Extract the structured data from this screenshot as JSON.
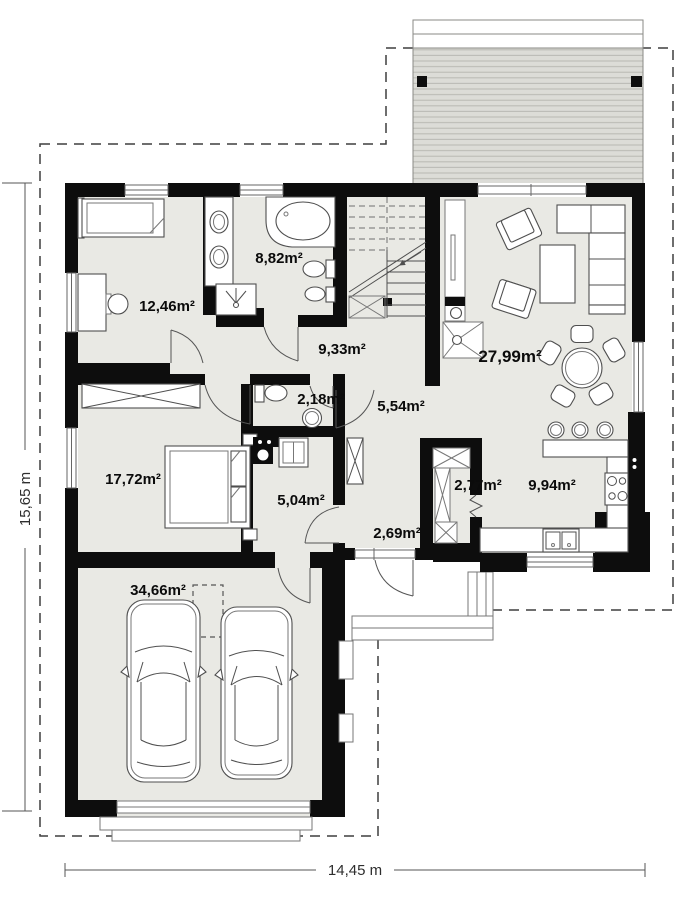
{
  "plan": {
    "rooms": [
      {
        "name": "bedroom-1",
        "area": "12,46m²"
      },
      {
        "name": "bathroom",
        "area": "8,82m²"
      },
      {
        "name": "hall",
        "area": "9,33m²"
      },
      {
        "name": "living-room",
        "area": "27,99m²"
      },
      {
        "name": "wc",
        "area": "2,18m²"
      },
      {
        "name": "corridor",
        "area": "5,54m²"
      },
      {
        "name": "bedroom-2",
        "area": "17,72m²"
      },
      {
        "name": "utility",
        "area": "5,04m²"
      },
      {
        "name": "pantry",
        "area": "2,77m²"
      },
      {
        "name": "kitchen",
        "area": "9,94m²"
      },
      {
        "name": "entry",
        "area": "2,69m²"
      },
      {
        "name": "garage",
        "area": "34,66m²"
      }
    ],
    "dimensions": {
      "width": "14,45 m",
      "height": "15,65 m"
    },
    "colors": {
      "wall": "#0d0d0d",
      "floor": "#e9e9e4",
      "deck": "#dcdcd7",
      "deck_line": "#b8b8b2",
      "furniture_stroke": "#4f4f4f"
    }
  }
}
